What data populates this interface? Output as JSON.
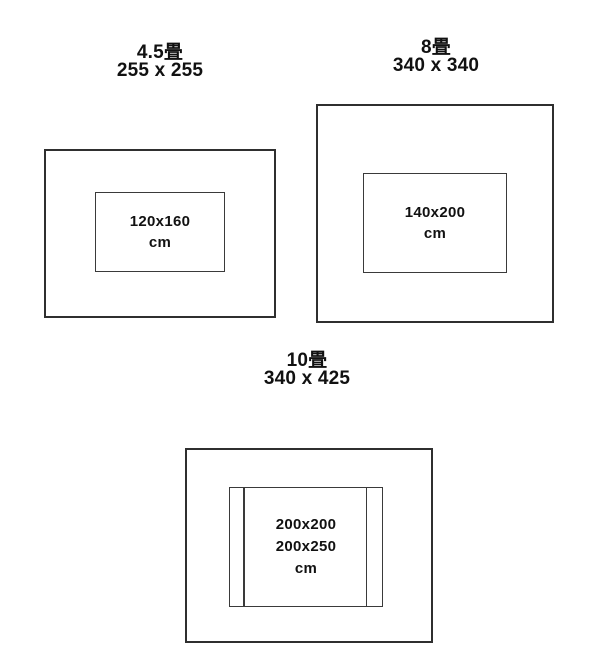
{
  "page": {
    "background_color": "#ffffff",
    "line_color": "#2f2f2f",
    "text_color": "#111111"
  },
  "diagrams": [
    {
      "id": "room-4-5-tatami",
      "title": "4.5畳",
      "room_size": "255 x 255",
      "rug_lines": [
        "120x160",
        "cm"
      ]
    },
    {
      "id": "room-8-tatami",
      "title": "8畳",
      "room_size": "340 x 340",
      "rug_lines": [
        "140x200",
        "cm"
      ]
    },
    {
      "id": "room-10-tatami",
      "title": "10畳",
      "room_size": "340 x 425",
      "rug_lines": [
        "200x200",
        "200x250",
        "cm"
      ]
    }
  ]
}
